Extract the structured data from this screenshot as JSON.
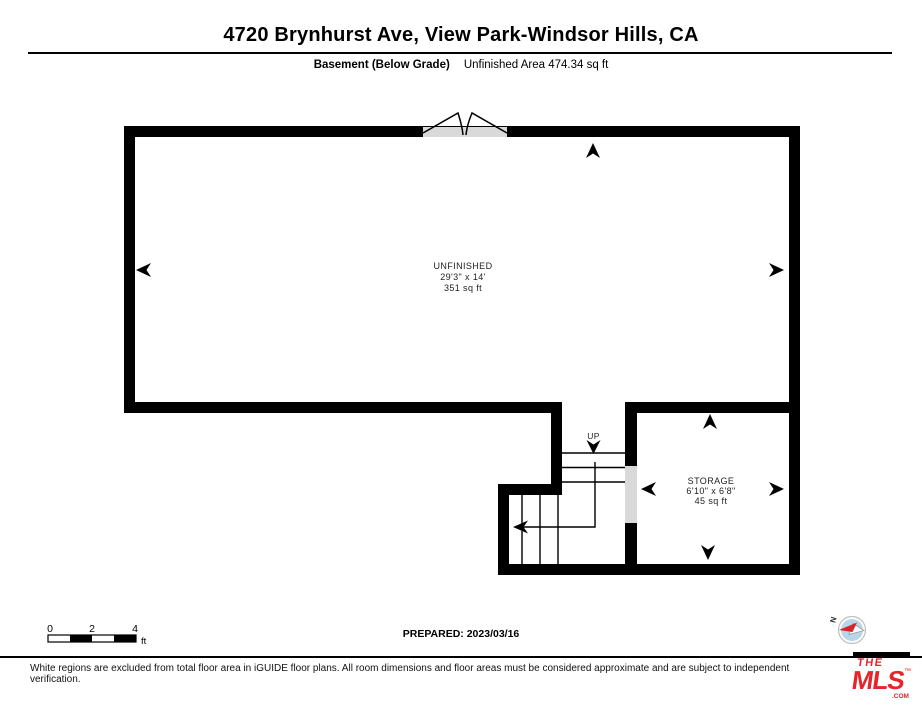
{
  "header": {
    "title": "4720 Brynhurst Ave, View Park-Windsor Hills, CA",
    "floor_label": "Basement (Below Grade)",
    "area_label": "Unfinished Area 474.34 sq ft"
  },
  "rooms": {
    "unfinished": {
      "name": "UNFINISHED",
      "dimensions": "29'3\" x 14'",
      "area": "351 sq ft"
    },
    "storage": {
      "name": "STORAGE",
      "dimensions": "6'10\" x 6'8\"",
      "area": "45 sq ft"
    }
  },
  "stairs": {
    "up_label": "UP"
  },
  "scale_bar": {
    "ticks": [
      "0",
      "2",
      "4"
    ],
    "unit": "ft"
  },
  "compass": {
    "north_label": "N"
  },
  "footer": {
    "prepared": "PREPARED: 2023/03/16",
    "disclaimer": "White regions are excluded from total floor area in iGUIDE floor plans. All room dimensions and floor areas must be considered approximate and are subject to independent verification."
  },
  "logo": {
    "the": "THE",
    "mls": "MLS",
    "com": ".COM",
    "tm": "™"
  },
  "colors": {
    "wall": "#000000",
    "door_opening": "#d9d9d9",
    "brand_red": "#e4252b",
    "compass_fill": "#b7d7e8",
    "needle_red": "#d8232a"
  }
}
